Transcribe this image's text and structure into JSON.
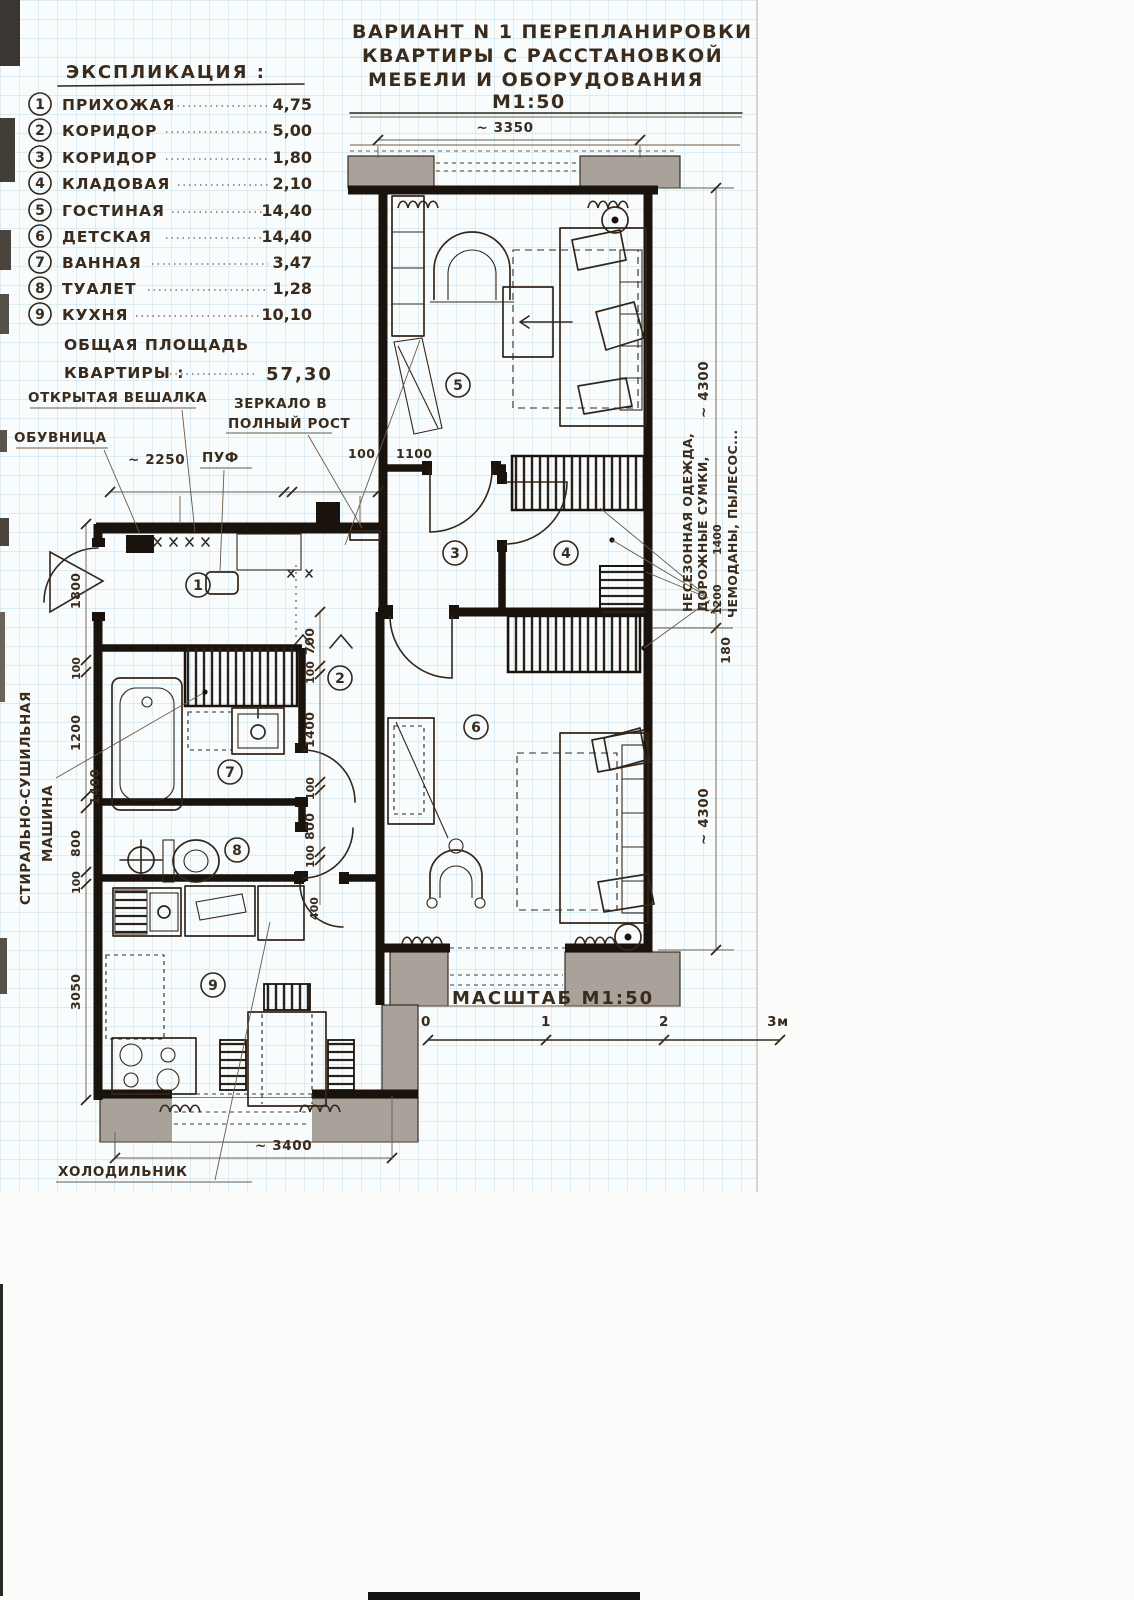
{
  "title": {
    "line1": "ВАРИАНТ N 1 ПЕРЕПЛАНИРОВКИ",
    "line2": "КВАРТИРЫ С РАССТАНОВКОЙ",
    "line3": "МЕБЕЛИ И ОБОРУДОВАНИЯ",
    "line4": "М1:50"
  },
  "legend": {
    "header": "ЭКСПЛИКАЦИЯ :",
    "items": [
      {
        "num": "1",
        "name": "ПРИХОЖАЯ",
        "value": "4,75"
      },
      {
        "num": "2",
        "name": "КОРИДОР",
        "value": "5,00"
      },
      {
        "num": "3",
        "name": "КОРИДОР",
        "value": "1,80"
      },
      {
        "num": "4",
        "name": "КЛАДОВАЯ",
        "value": "2,10"
      },
      {
        "num": "5",
        "name": "ГОСТИНАЯ",
        "value": "14,40"
      },
      {
        "num": "6",
        "name": "ДЕТСКАЯ",
        "value": "14,40"
      },
      {
        "num": "7",
        "name": "ВАННАЯ",
        "value": "3,47"
      },
      {
        "num": "8",
        "name": "ТУАЛЕТ",
        "value": "1,28"
      },
      {
        "num": "9",
        "name": "КУХНЯ",
        "value": "10,10"
      }
    ],
    "total_label_1": "ОБЩАЯ ПЛОЩАДЬ",
    "total_label_2": "КВАРТИРЫ :",
    "total_value": "57,30"
  },
  "plan": {
    "rooms": [
      "1",
      "2",
      "3",
      "4",
      "5",
      "6",
      "7",
      "8",
      "9"
    ]
  },
  "annotations": {
    "open_hanger": "ОТКРЫТАЯ ВЕШАЛКА",
    "mirror_1": "ЗЕРКАЛО В",
    "mirror_2": "ПОЛНЫЙ РОСТ",
    "shoe_cabinet": "ОБУВНИЦА",
    "pouf": "ПУФ",
    "washer_1": "СТИРАЛЬНО-СУШИЛЬНАЯ",
    "washer_2": "МАШИНА",
    "closet_1": "НЕСЕЗОННАЯ ОДЕЖДА,",
    "closet_2": "ДОРОЖНЫЕ СУМКИ,",
    "closet_3": "ЧЕМОДАНЫ, ПЫЛЕСОС...",
    "fridge": "ХОЛОДИЛЬНИК"
  },
  "dimensions": {
    "top": "~ 3350",
    "right_top": "~ 4300",
    "right_step": "180",
    "right_bottom": "~ 4300",
    "bottom": "~ 3400",
    "hall_width": "~ 2250",
    "hall_100": "100",
    "hall_1100": "1100",
    "closet_1200": "1200",
    "closet_1400": "1400",
    "kitchen_door": "400",
    "left_chain": [
      "1800",
      "100",
      "1200",
      "1400",
      "800",
      "100",
      "3050"
    ],
    "mid_chain": [
      "700",
      "100",
      "1400",
      "100",
      "800",
      "100"
    ]
  },
  "scale_bar": {
    "label": "МАСШТАБ М1:50",
    "tick_0": "0",
    "tick_1": "1",
    "tick_2": "2",
    "tick_3": "3м"
  }
}
